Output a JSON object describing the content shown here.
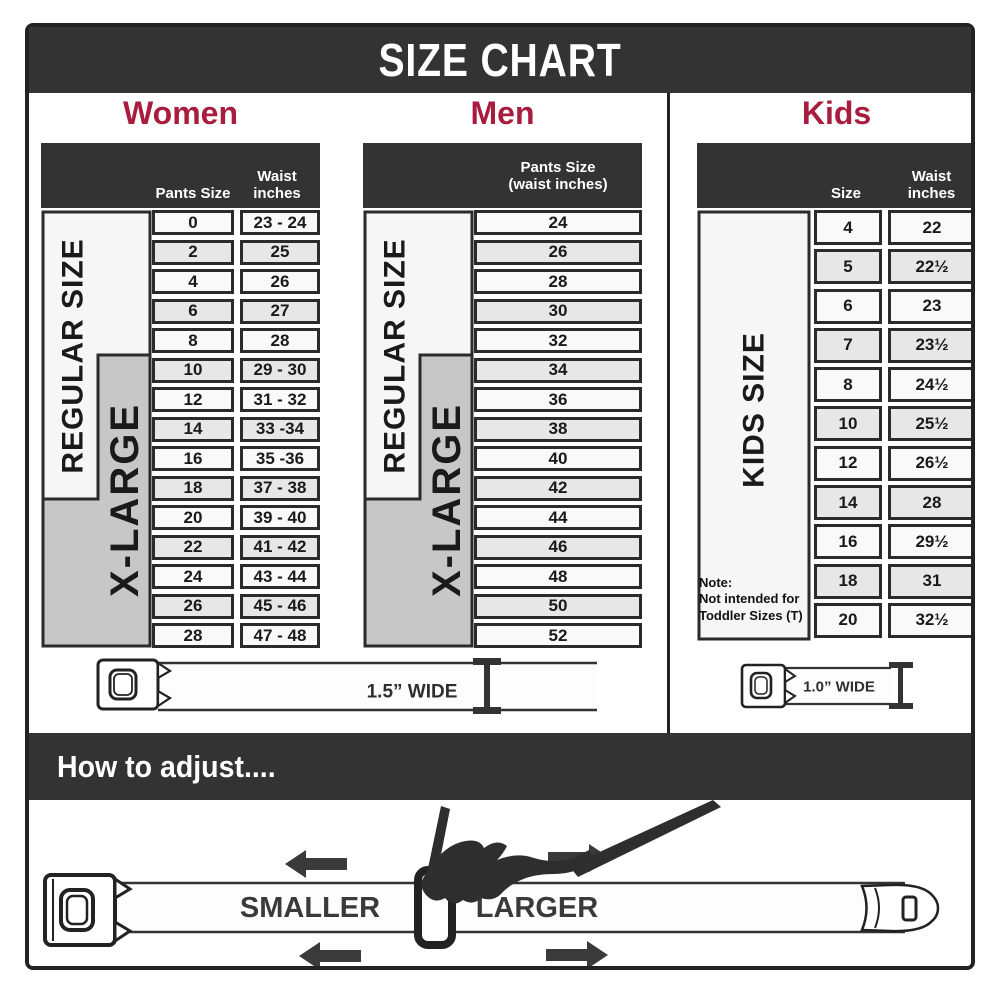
{
  "title": "SIZE CHART",
  "colors": {
    "band": "#333333",
    "accent": "#A81D3D",
    "cell_border": "#2b2b2b",
    "row_light": "#f9f9f9",
    "row_alt": "#e7e7e7",
    "sidebar_gray": "#c7c7c7"
  },
  "women": {
    "label": "Women",
    "side_regular": "REGULAR SIZE",
    "side_xlarge": "X-LARGE",
    "col1_header": "Pants Size",
    "col2_header": "Waist\ninches",
    "rows": [
      [
        "0",
        "23 - 24"
      ],
      [
        "2",
        "25"
      ],
      [
        "4",
        "26"
      ],
      [
        "6",
        "27"
      ],
      [
        "8",
        "28"
      ],
      [
        "10",
        "29 - 30"
      ],
      [
        "12",
        "31 - 32"
      ],
      [
        "14",
        "33 -34"
      ],
      [
        "16",
        "35 -36"
      ],
      [
        "18",
        "37 - 38"
      ],
      [
        "20",
        "39 - 40"
      ],
      [
        "22",
        "41 - 42"
      ],
      [
        "24",
        "43 - 44"
      ],
      [
        "26",
        "45 - 46"
      ],
      [
        "28",
        "47 - 48"
      ]
    ]
  },
  "men": {
    "label": "Men",
    "col_header": "Pants Size\n(waist inches)",
    "side_regular": "REGULAR SIZE",
    "side_xlarge": "X-LARGE",
    "rows": [
      "24",
      "26",
      "28",
      "30",
      "32",
      "34",
      "36",
      "38",
      "40",
      "42",
      "44",
      "46",
      "48",
      "50",
      "52"
    ]
  },
  "kids": {
    "label": "Kids",
    "side_label": "KIDS SIZE",
    "col1_header": "Size",
    "col2_header": "Waist\ninches",
    "note": "Note:\nNot intended for\nToddler Sizes (T)",
    "rows": [
      [
        "4",
        "22"
      ],
      [
        "5",
        "22½"
      ],
      [
        "6",
        "23"
      ],
      [
        "7",
        "23½"
      ],
      [
        "8",
        "24½"
      ],
      [
        "10",
        "25½"
      ],
      [
        "12",
        "26½"
      ],
      [
        "14",
        "28"
      ],
      [
        "16",
        "29½"
      ],
      [
        "18",
        "31"
      ],
      [
        "20",
        "32½"
      ]
    ]
  },
  "belts": {
    "adult_label": "1.5” WIDE",
    "kids_label": "1.0” WIDE"
  },
  "adjust": {
    "heading": "How to adjust....",
    "smaller_label": "SMALLER",
    "larger_label": "LARGER"
  },
  "chart_data": [
    {
      "type": "table",
      "title": "Women",
      "columns": [
        "Pants Size",
        "Waist inches"
      ],
      "rows": [
        [
          "0",
          "23 - 24"
        ],
        [
          "2",
          "25"
        ],
        [
          "4",
          "26"
        ],
        [
          "6",
          "27"
        ],
        [
          "8",
          "28"
        ],
        [
          "10",
          "29 - 30"
        ],
        [
          "12",
          "31 - 32"
        ],
        [
          "14",
          "33 -34"
        ],
        [
          "16",
          "35 -36"
        ],
        [
          "18",
          "37 - 38"
        ],
        [
          "20",
          "39 - 40"
        ],
        [
          "22",
          "41 - 42"
        ],
        [
          "24",
          "43 - 44"
        ],
        [
          "26",
          "45 - 46"
        ],
        [
          "28",
          "47 - 48"
        ]
      ],
      "regular_size_rows": [
        "0",
        "2",
        "4",
        "6",
        "8",
        "10",
        "12",
        "14",
        "16",
        "18"
      ],
      "x_large_rows": [
        "10",
        "12",
        "14",
        "16",
        "18",
        "20",
        "22",
        "24",
        "26",
        "28"
      ],
      "belt_width": "1.5” WIDE"
    },
    {
      "type": "table",
      "title": "Men",
      "columns": [
        "Pants Size (waist inches)"
      ],
      "rows": [
        [
          "24"
        ],
        [
          "26"
        ],
        [
          "28"
        ],
        [
          "30"
        ],
        [
          "32"
        ],
        [
          "34"
        ],
        [
          "36"
        ],
        [
          "38"
        ],
        [
          "40"
        ],
        [
          "42"
        ],
        [
          "44"
        ],
        [
          "46"
        ],
        [
          "48"
        ],
        [
          "50"
        ],
        [
          "52"
        ]
      ],
      "regular_size_rows": [
        "24",
        "26",
        "28",
        "30",
        "32",
        "34",
        "36",
        "38",
        "40",
        "42"
      ],
      "x_large_rows": [
        "34",
        "36",
        "38",
        "40",
        "42",
        "44",
        "46",
        "48",
        "50",
        "52"
      ],
      "belt_width": "1.5” WIDE"
    },
    {
      "type": "table",
      "title": "Kids",
      "columns": [
        "Size",
        "Waist inches"
      ],
      "rows": [
        [
          "4",
          "22"
        ],
        [
          "5",
          "22½"
        ],
        [
          "6",
          "23"
        ],
        [
          "7",
          "23½"
        ],
        [
          "8",
          "24½"
        ],
        [
          "10",
          "25½"
        ],
        [
          "12",
          "26½"
        ],
        [
          "14",
          "28"
        ],
        [
          "16",
          "29½"
        ],
        [
          "18",
          "31"
        ],
        [
          "20",
          "32½"
        ]
      ],
      "group": "KIDS SIZE",
      "note": "Note: Not intended for Toddler Sizes (T)",
      "belt_width": "1.0” WIDE"
    }
  ]
}
